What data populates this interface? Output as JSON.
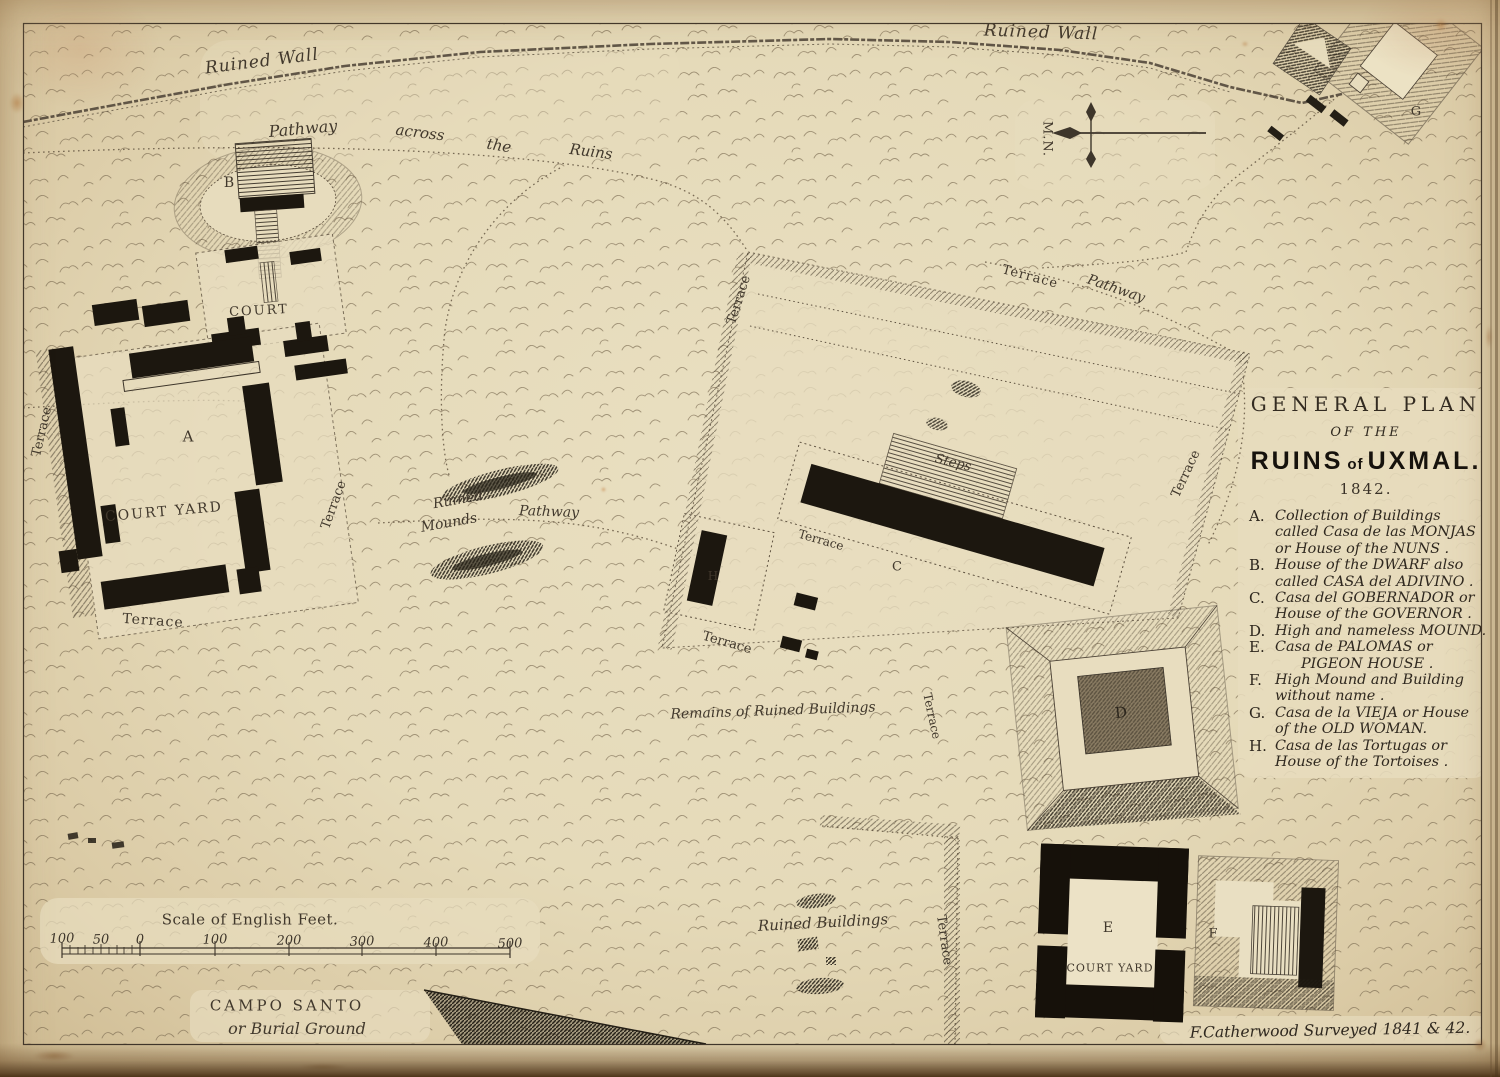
{
  "palette": {
    "paper": "#e6dbbc",
    "paper_edge": "#d3c09a",
    "ink": "#41382c",
    "building_black": "#1c170f",
    "fold_brown": "#5e4326"
  },
  "title_block": {
    "title1": "GENERAL PLAN",
    "title2": "OF THE",
    "title3a": "RUINS",
    "title3b": "of",
    "title3c": "UXMAL.",
    "year": "1842.",
    "legend": [
      {
        "key": "A.",
        "lines": [
          "Collection of Buildings",
          "called Casa de las MONJAS",
          "or House of the NUNS ."
        ]
      },
      {
        "key": "B.",
        "lines": [
          "House of the DWARF also",
          "called  CASA del ADIVINO ."
        ]
      },
      {
        "key": "C.",
        "lines": [
          "Casa del GOBERNADOR or",
          "House of the GOVERNOR ."
        ]
      },
      {
        "key": "D.",
        "lines": [
          "High and nameless MOUND."
        ]
      },
      {
        "key": "E.",
        "lines": [
          "Casa de PALOMAS  or",
          "PIGEON HOUSE ."
        ]
      },
      {
        "key": "F.",
        "lines": [
          "High Mound and Building",
          "without name ."
        ]
      },
      {
        "key": "G.",
        "lines": [
          "Casa de la VIEJA or House",
          "of the  OLD WOMAN."
        ]
      },
      {
        "key": "H.",
        "lines": [
          "Casa de las Tortugas or",
          "House of the Tortoises ."
        ]
      }
    ]
  },
  "map_labels": {
    "ruined_wall": "Ruined Wall",
    "pathway": "Pathway",
    "across": "across",
    "the": "the",
    "ruins": "Ruins",
    "terrace": "Terrace",
    "steps": "Steps",
    "court": "COURT",
    "court_yard": "COURT YARD",
    "ruined": "Ruined",
    "mounds": "Mounds",
    "remains": "Remains of Ruined Buildings",
    "ruined_buildings": "Ruined Buildings",
    "campo_santo": "CAMPO SANTO",
    "burial_ground": "or Burial Ground",
    "letter_a": "A",
    "letter_b": "B",
    "letter_c": "C",
    "letter_d": "D",
    "letter_e": "E",
    "letter_f": "F",
    "letter_g": "G",
    "letter_h": "H"
  },
  "compass": {
    "label": "M.N."
  },
  "scale_bar": {
    "title": "Scale of English Feet.",
    "ticks": [
      "100",
      "50",
      "0",
      "100",
      "200",
      "300",
      "400",
      "500"
    ]
  },
  "credit": "F.Catherwood  Surveyed 1841 & 42."
}
